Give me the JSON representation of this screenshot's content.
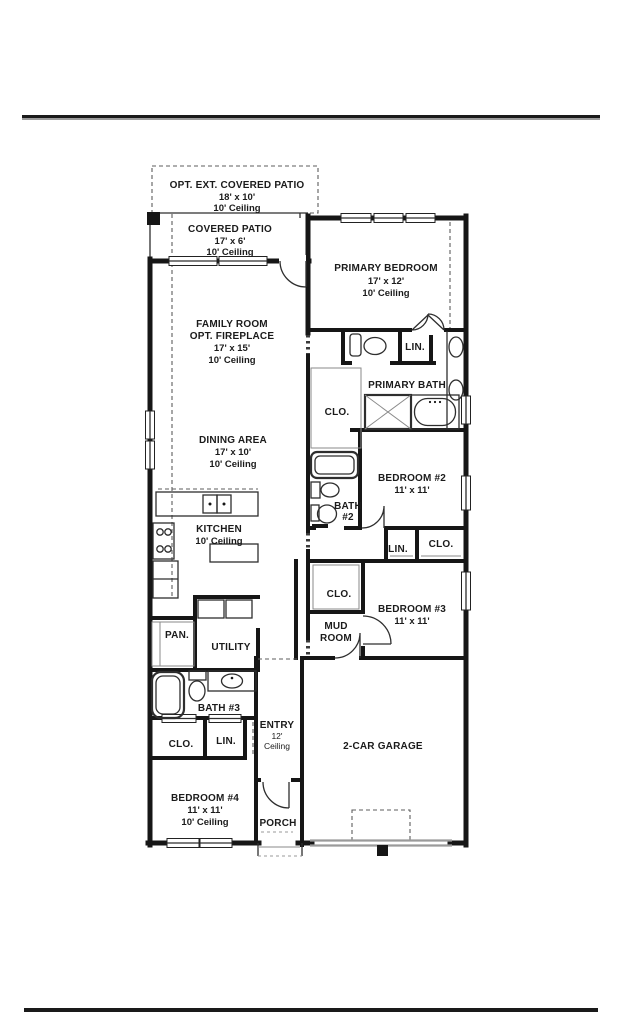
{
  "colors": {
    "wall": "#161616",
    "garage_door_gray": "#9a9a9a"
  },
  "rooms": {
    "opt_ext_covered_patio": {
      "name": "OPT. EXT. COVERED PATIO",
      "dims": "18' x 10'",
      "ceiling": "10' Ceiling"
    },
    "covered_patio": {
      "name": "COVERED PATIO",
      "dims": "17' x 6'",
      "ceiling": "10' Ceiling"
    },
    "primary_bedroom": {
      "name": "PRIMARY BEDROOM",
      "dims": "17' x 12'",
      "ceiling": "10' Ceiling"
    },
    "family_room": {
      "name": "FAMILY ROOM",
      "option": "OPT. FIREPLACE",
      "dims": "17' x 15'",
      "ceiling": "10' Ceiling"
    },
    "linen_primary": {
      "name": "LIN."
    },
    "primary_bath": {
      "name": "PRIMARY BATH"
    },
    "closet_primary": {
      "name": "CLO."
    },
    "dining_area": {
      "name": "DINING AREA",
      "dims": "17' x 10'",
      "ceiling": "10' Ceiling"
    },
    "bedroom_2": {
      "name": "BEDROOM #2",
      "dims": "11' x 11'"
    },
    "bath_2": {
      "name": "BATH",
      "name2": "#2"
    },
    "kitchen": {
      "name": "KITCHEN",
      "ceiling": "10' Ceiling"
    },
    "linen_hall": {
      "name": "LIN."
    },
    "closet_hall": {
      "name": "CLO."
    },
    "closet_bedroom3": {
      "name": "CLO."
    },
    "bedroom_3": {
      "name": "BEDROOM #3",
      "dims": "11' x 11'"
    },
    "pantry": {
      "name": "PAN."
    },
    "utility": {
      "name": "UTILITY"
    },
    "mud_room": {
      "name": "MUD",
      "name2": "ROOM"
    },
    "bath_3": {
      "name": "BATH #3"
    },
    "entry": {
      "name": "ENTRY",
      "dims": "12'",
      "ceiling": "Ceiling"
    },
    "garage": {
      "name": "2-CAR GARAGE"
    },
    "closet_bedroom4": {
      "name": "CLO."
    },
    "linen_bedroom4": {
      "name": "LIN."
    },
    "bedroom_4": {
      "name": "BEDROOM #4",
      "dims": "11' x 11'",
      "ceiling": "10' Ceiling"
    },
    "porch": {
      "name": "PORCH"
    }
  }
}
